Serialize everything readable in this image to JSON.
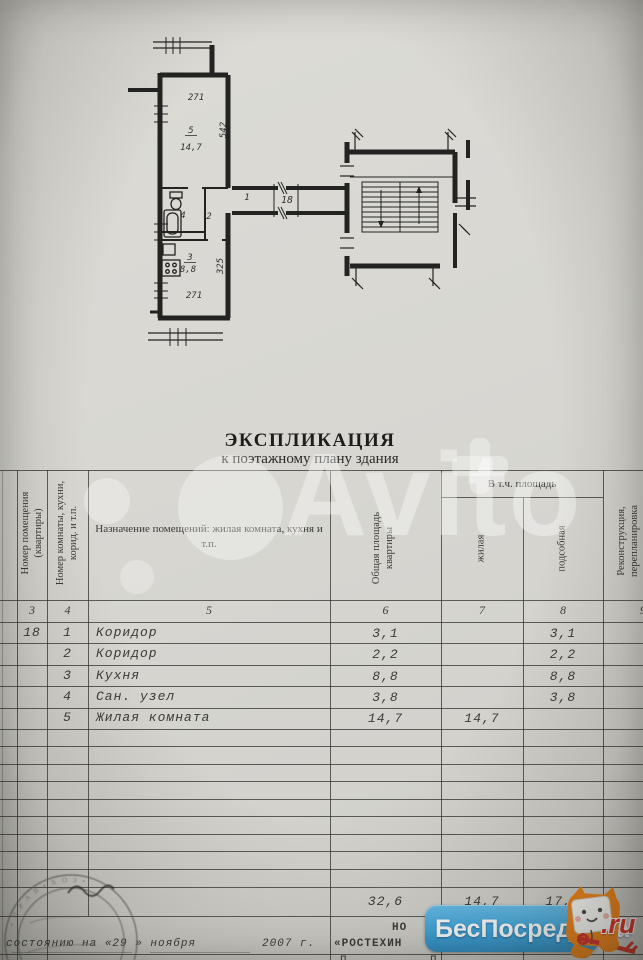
{
  "document": {
    "title": "ЭКСПЛИКАЦИЯ",
    "subtitle": "к поэтажному плану здания"
  },
  "plan": {
    "dim_top": "271",
    "room5_num": "5",
    "room5_area": "14,7",
    "dim_right_top": "542",
    "bath_num": "4",
    "hall2_num": "2",
    "kitchen_num": "3",
    "kitchen_area": "8,8",
    "dim_right_bottom": "325",
    "dim_bottom": "271",
    "hall1_num": "1",
    "flat_num": "18"
  },
  "table": {
    "headers": {
      "col3": "Номер помещения (квартиры)",
      "col4": "Номер комнаты, кухни, корид. и т.п.",
      "col5": "Назначение помещений: жилая комната, кухня и т.п.",
      "col6": "Общая площадь квартиры",
      "incl_group": "В т.ч. площадь",
      "col7": "жилая",
      "col8": "подсобная",
      "col9_line1": "Реконструкция,",
      "col9_line2": "перепланировка"
    },
    "column_numbers": {
      "c3": "3",
      "c4": "4",
      "c5": "5",
      "c6": "6",
      "c7": "7",
      "c8": "8",
      "c9": "9"
    },
    "rows": [
      {
        "flat": "18",
        "num": "1",
        "name": "Коридор",
        "total": "3,1",
        "living": "",
        "aux": "3,1"
      },
      {
        "flat": "",
        "num": "2",
        "name": "Коридор",
        "total": "2,2",
        "living": "",
        "aux": "2,2"
      },
      {
        "flat": "",
        "num": "3",
        "name": "Кухня",
        "total": "8,8",
        "living": "",
        "aux": "8,8"
      },
      {
        "flat": "",
        "num": "4",
        "name": "Сан. узел",
        "total": "3,8",
        "living": "",
        "aux": "3,8"
      },
      {
        "flat": "",
        "num": "5",
        "name": "Жилая комната",
        "total": "14,7",
        "living": "14,7",
        "aux": ""
      }
    ],
    "totals": {
      "total": "32,6",
      "living": "14,7",
      "aux": "17,9"
    }
  },
  "footer": {
    "fragment_no": "НО",
    "org_fragment": "«РОСТЕХИН",
    "date_fragment": "состоянию на «29 » ноября",
    "year": "2007 г.",
    "partial_row_left": "П",
    "partial_row_right": "П"
  },
  "stamp": {
    "curved_text": "• П Р А В •  Х О З •"
  },
  "watermarks": {
    "avito": "Avito",
    "agency": "БесПосредника",
    "agency_tld": ".ru"
  },
  "colors": {
    "logo_blue": "#3fa7dc",
    "logo_orange": "#f08519",
    "logo_red": "#de3226"
  }
}
